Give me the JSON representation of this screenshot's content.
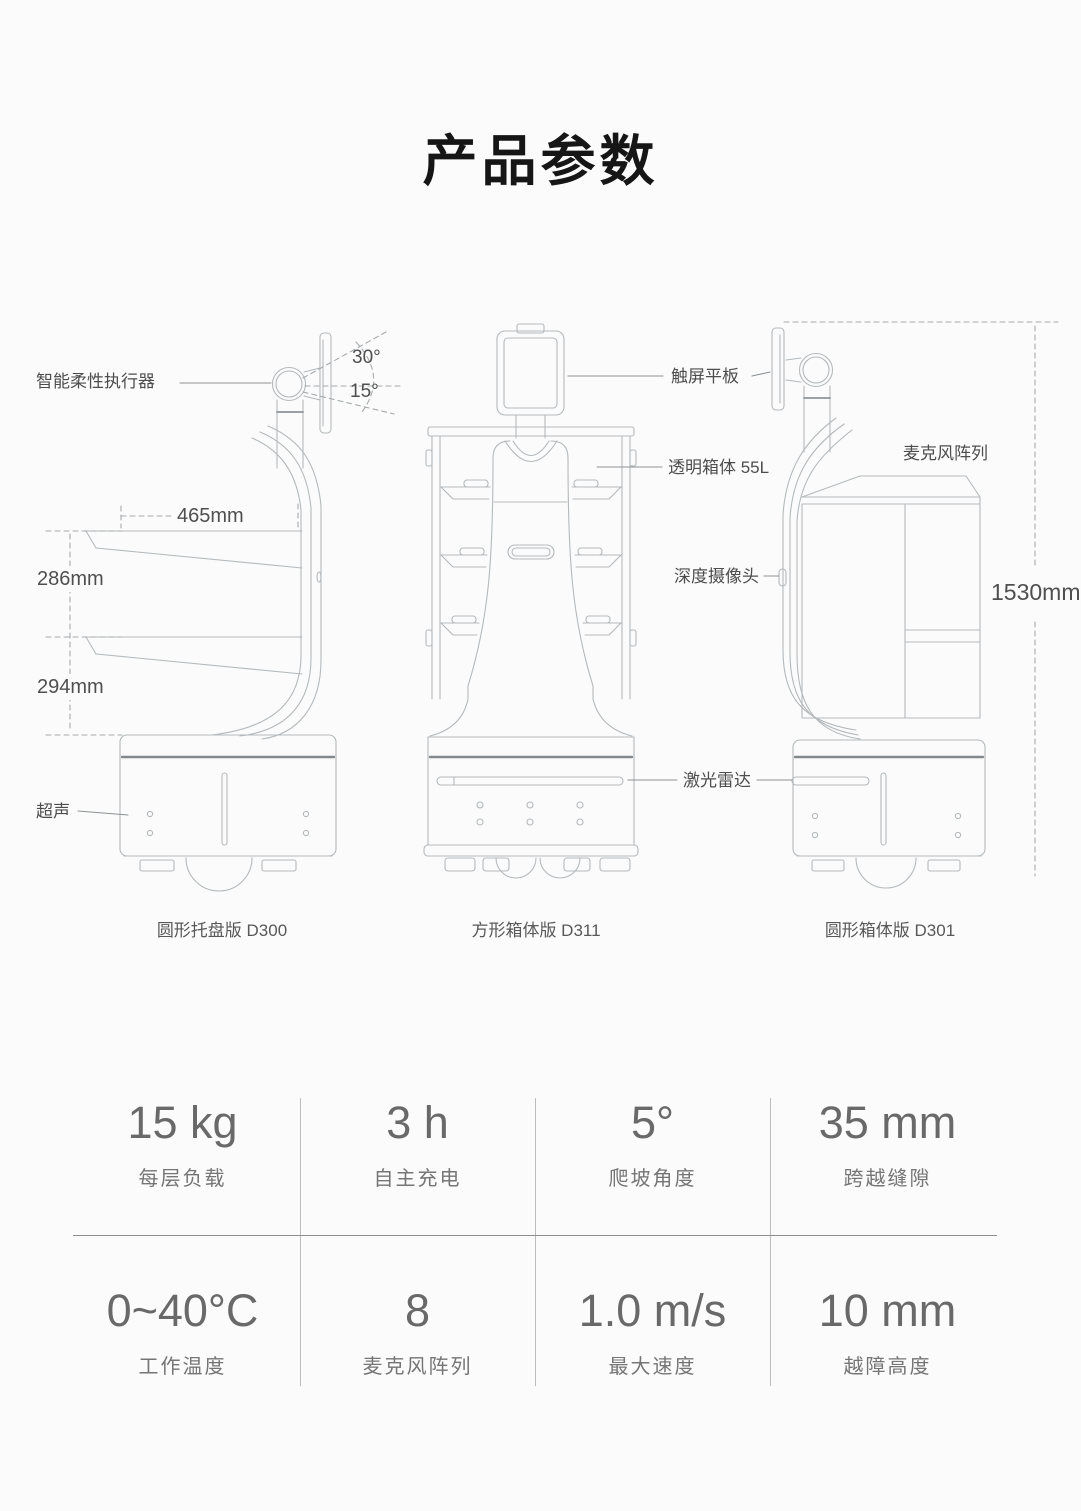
{
  "page": {
    "title": "产品参数"
  },
  "diagram": {
    "labels": {
      "actuator": "智能柔性执行器",
      "angle_up": "30°",
      "angle_down": "15°",
      "dim_width": "465mm",
      "dim_gap1": "286mm",
      "dim_gap2": "294mm",
      "ultrasonic": "超声",
      "touchscreen": "触屏平板",
      "transparent_box": "透明箱体 55L",
      "depth_camera": "深度摄像头",
      "lidar": "激光雷达",
      "mic_array": "麦克风阵列",
      "dim_height": "1530mm"
    },
    "captions": [
      "圆形托盘版 D300",
      "方形箱体版 D311",
      "圆形箱体版 D301"
    ]
  },
  "specs": {
    "rows": [
      [
        {
          "value": "15 kg",
          "label": "每层负载"
        },
        {
          "value": "3 h",
          "label": "自主充电"
        },
        {
          "value": "5°",
          "label": "爬坡角度"
        },
        {
          "value": "35 mm",
          "label": "跨越缝隙"
        }
      ],
      [
        {
          "value": "0~40°C",
          "label": "工作温度"
        },
        {
          "value": "8",
          "label": "麦克风阵列"
        },
        {
          "value": "1.0 m/s",
          "label": "最大速度"
        },
        {
          "value": "10 mm",
          "label": "越障高度"
        }
      ]
    ]
  },
  "colors": {
    "line": "#b4b9bc",
    "accent": "#83888b",
    "label_text": "#4d4d4d",
    "divider": "#8e8e8e"
  }
}
